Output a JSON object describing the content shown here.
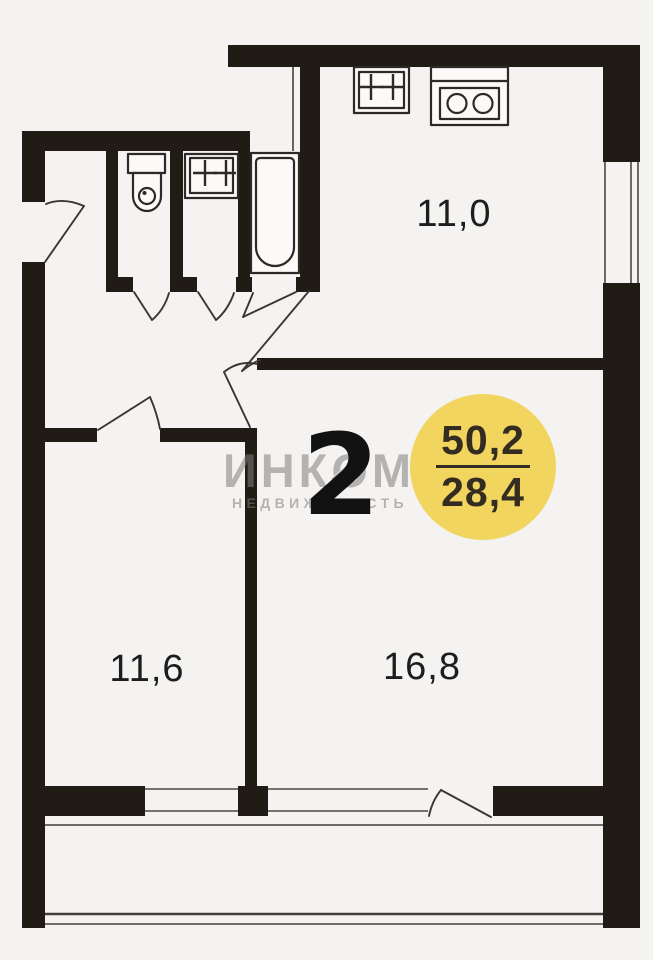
{
  "floorplan": {
    "watermark": {
      "brand": "ИНКОМ",
      "subtitle": "НЕДВИЖИМОСТЬ"
    },
    "room_count": "2",
    "area_badge": {
      "total_area": "50,2",
      "living_area": "28,4"
    },
    "rooms": {
      "kitchen": {
        "area": "11,0"
      },
      "bedroom": {
        "area": "11,6"
      },
      "living_room": {
        "area": "16,8"
      }
    },
    "fixtures": [
      "toilet",
      "washbasin",
      "bathtub",
      "kitchen-sink",
      "stove"
    ],
    "colors": {
      "wall": "#211b15",
      "background": "#f4f3f1",
      "badge_background": "#f2d55e",
      "badge_text": "#332d21",
      "watermark_gray": "#8f8d8b",
      "label_text": "#1d1d1d"
    }
  }
}
